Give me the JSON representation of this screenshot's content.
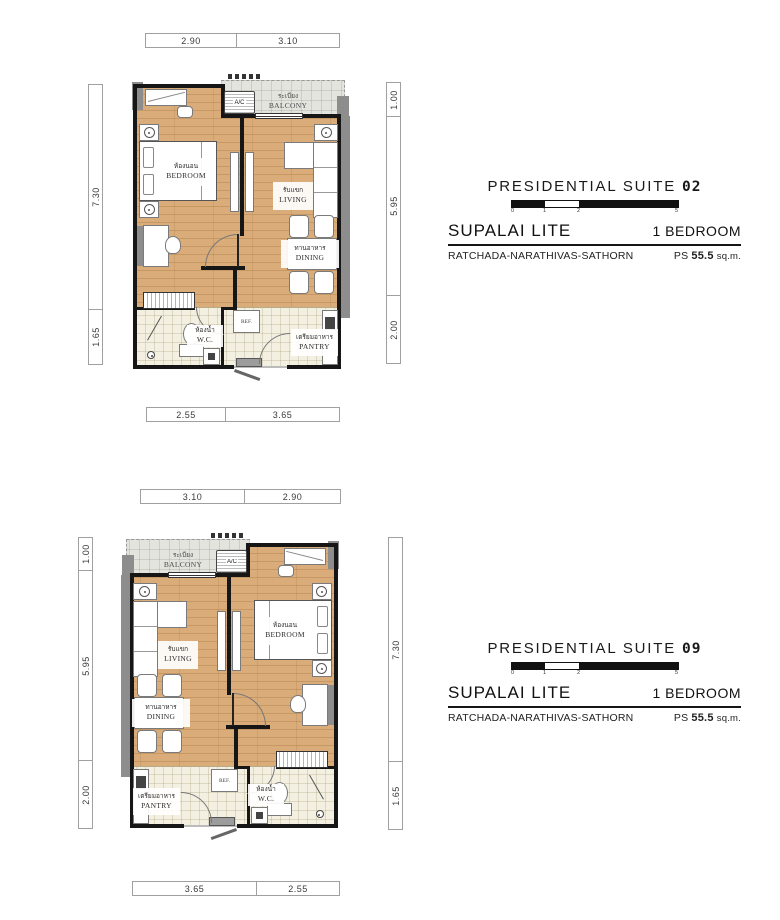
{
  "rooms": {
    "bedroom": {
      "th": "ห้องนอน",
      "en": "BEDROOM"
    },
    "living": {
      "th": "รับแขก",
      "en": "LIVING"
    },
    "dining": {
      "th": "ทานอาหาร",
      "en": "DINING"
    },
    "wc": {
      "th": "ห้องน้ำ",
      "en": "W.C."
    },
    "pantry": {
      "th": "เตรียมอาหาร",
      "en": "PANTRY"
    },
    "balcony": {
      "th": "ระเบียง",
      "en": "BALCONY"
    },
    "ac_label": "A/C",
    "fridge_label": "REF."
  },
  "plans": [
    {
      "name": "PRESIDENTIAL SUITE",
      "number": "02",
      "project": "SUPALAI LITE",
      "bedroom_type": "1 BEDROOM",
      "location": "RATCHADA-NARATHIVAS-SATHORN",
      "area_prefix": "PS",
      "area_value": "55.5",
      "area_unit": "sq.m.",
      "scale_ticks": [
        "0",
        "1",
        "2",
        "5"
      ],
      "dims": {
        "top": [
          "2.90",
          "3.10"
        ],
        "bottom": [
          "2.55",
          "3.65"
        ],
        "left": [
          "7.30",
          "1.65"
        ],
        "right": [
          "1.00",
          "5.95",
          "2.00"
        ]
      }
    },
    {
      "name": "PRESIDENTIAL SUITE",
      "number": "09",
      "project": "SUPALAI LITE",
      "bedroom_type": "1 BEDROOM",
      "location": "RATCHADA-NARATHIVAS-SATHORN",
      "area_prefix": "PS",
      "area_value": "55.5",
      "area_unit": "sq.m.",
      "scale_ticks": [
        "0",
        "1",
        "2",
        "5"
      ],
      "dims": {
        "top": [
          "3.10",
          "2.90"
        ],
        "bottom": [
          "3.65",
          "2.55"
        ],
        "left": [
          "1.00",
          "5.95",
          "2.00"
        ],
        "right": [
          "7.30",
          "1.65"
        ]
      }
    }
  ]
}
